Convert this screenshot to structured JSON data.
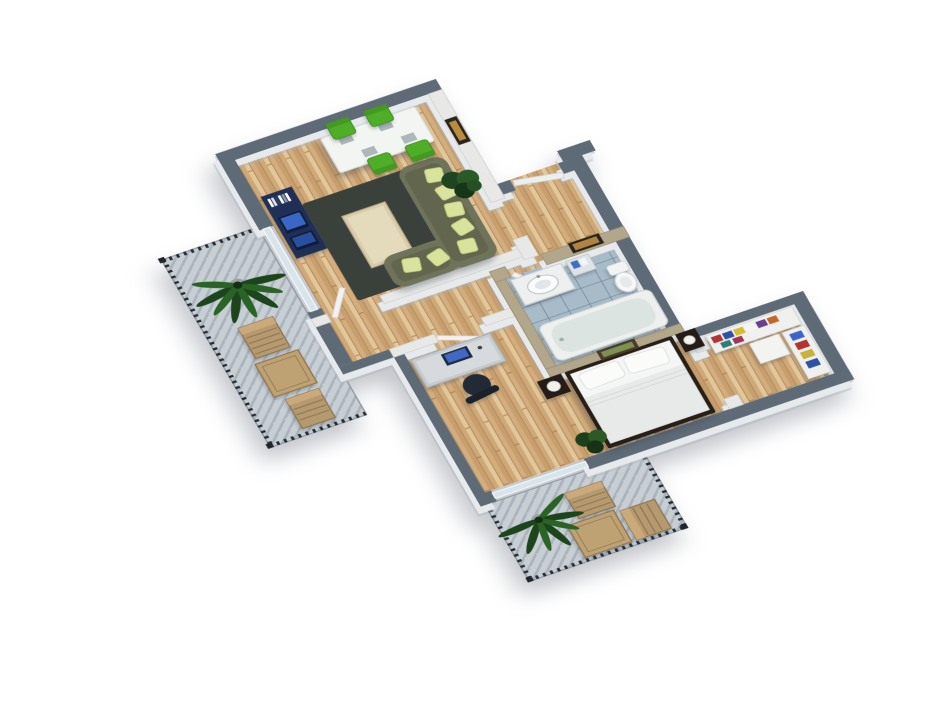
{
  "meta": {
    "title": "3D isometric floor plan render of a one-bedroom apartment",
    "view": "top-down axonometric, rotated diagonally on white background",
    "background": "#ffffff"
  },
  "palette": {
    "wallExterior": "#5e6b77",
    "wallInterior": "#e8e9e7",
    "wallBathroom": "#b2a68b",
    "wallFace": "#e7eaec",
    "woodBase": "#d8b88c",
    "tile": "#a8bbc9",
    "grout": "#6d8595",
    "deck": "#c7ced4",
    "deckStripe": "#aab3bb",
    "railing": "#262d34",
    "sofa": "#6f7359",
    "sofaCushion": "#62664e",
    "pillow": "#d9e39c",
    "chairGreen": "#4fae27",
    "tableWhite": "#f3f5f2",
    "rug": "#3a403a",
    "coffeeTable": "#d9cdad",
    "tvConsole": "#1f2f55",
    "tvScreen": "#3a67c6",
    "bedFrame": "#261e17",
    "duvet": "#e8eae9",
    "pillowWhite": "#fbfbfa",
    "nightstand": "#241c16",
    "desk": "#c6cbcf",
    "monitorScreen": "#3f69c2",
    "officeChair": "#222a35",
    "plantDark": "#1c451c",
    "plantLight": "#2a6326",
    "woodFurniture": "#b59a70",
    "tub": "#eef0ee",
    "tubInner": "#dce4e2",
    "porcelain": "#f6f7f6",
    "glass": "#d7e4ea",
    "door": "#f1f2f1",
    "pictureFrame": "#2b241d",
    "pictureArt": "#b08440",
    "artGreen": "#7d9153"
  },
  "rooms": [
    {
      "id": "living-room",
      "furniture": [
        "tv-console-with-blue-screens",
        "dark-rug",
        "cream-coffee-table",
        "l-shaped-olive-sofa",
        "light-green-pillows",
        "white-dining-table-with-place-mats",
        "four-green-chairs",
        "potted-plant",
        "wall-picture"
      ]
    },
    {
      "id": "entry-hall",
      "furniture": [
        "front-door",
        "wall-picture"
      ]
    },
    {
      "id": "corridor",
      "furniture": [
        "white-open-doors"
      ]
    },
    {
      "id": "bathroom",
      "furniture": [
        "vanity-with-round-basin",
        "shelf-unit",
        "toilet",
        "bathtub"
      ],
      "floor": "blue-tile"
    },
    {
      "id": "walk-in-closet",
      "furniture": [
        "shelves-with-colorful-clothes",
        "white-cabinet"
      ]
    },
    {
      "id": "bedroom",
      "furniture": [
        "double-bed-white-duvet",
        "two-pillows",
        "two-dark-nightstands-with-lamps",
        "headboard-picture",
        "computer-desk",
        "monitor",
        "office-chair",
        "potted-plant"
      ]
    }
  ],
  "balconies": [
    {
      "id": "balcony-upper",
      "items": [
        "palm-plant",
        "two-wooden-lounge-chairs",
        "wooden-table",
        "dark-railing"
      ],
      "floor": "gray-decking"
    },
    {
      "id": "balcony-lower",
      "items": [
        "palm-plant",
        "two-wooden-lounge-chairs",
        "wooden-table",
        "dark-railing"
      ],
      "floor": "gray-decking"
    }
  ],
  "closet": {
    "clothes_colors": [
      "#b23434",
      "#2d52a8",
      "#d4bd35",
      "#f4f4f2",
      "#6d3d8f",
      "#c4662b",
      "#2f7d7a",
      "#a13459",
      "#3a66c9",
      "#c9b23a"
    ]
  }
}
